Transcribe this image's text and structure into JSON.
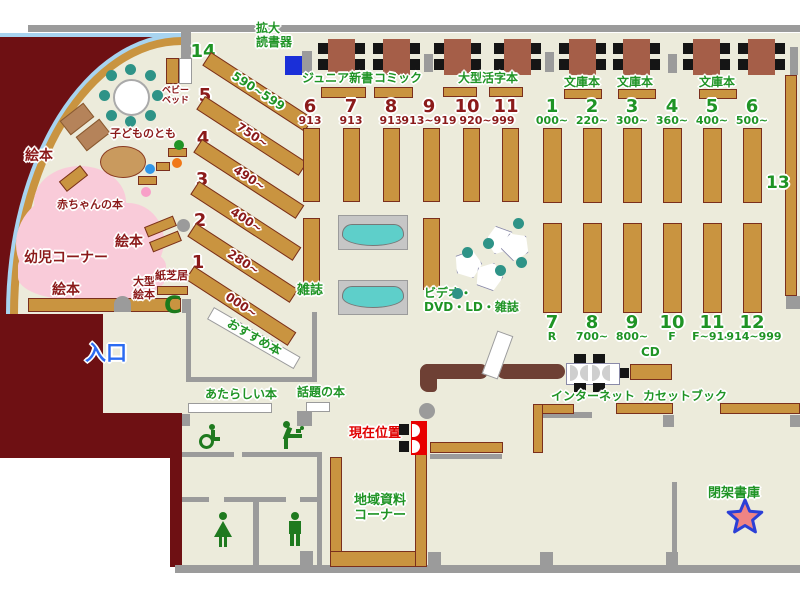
{
  "title": "library-floor-map",
  "colors": {
    "floor": "#ecebdb",
    "outside": "#6e1013",
    "wall": "#9b9b9b",
    "shelf_tan": "#c99440",
    "shelf_border": "#7a2f1d",
    "counter": "#6e4034",
    "table_brown": "#a55e48",
    "chair_black": "#151515",
    "teal_seat": "#2e9387",
    "magazine_rack_teal": "#5ecfca",
    "kids_pink": "#f9cbd9",
    "window_blue": "#a8d4f0",
    "label_green": "#1f9425",
    "label_dark_red": "#8b1a1a",
    "current_red": "#e00000",
    "entrance_blue": "#2b6bf2",
    "reader_blue": "#1a2fd8",
    "star_fill": "#ef8484",
    "star_stroke": "#2b3fd6"
  },
  "labels": {
    "magnifier_line1": "拡大",
    "magnifier_line2": "読書器",
    "junior_shinsho": "ジュニア新書",
    "comic": "コミック",
    "large_print": "大型活字本",
    "bunko_1": "文庫本",
    "bunko_2": "文庫本",
    "bunko_3": "文庫本",
    "magazines": "雑誌",
    "video_line1": "ビデオ・",
    "video_line2": "DVD・LD・雑誌",
    "recommended": "おすすめ本",
    "new_books": "あたらしい本",
    "topic_books": "話題の本",
    "local_line1": "地域資料",
    "local_line2": "コーナー",
    "internet": "インターネット",
    "cd": "CD",
    "cassette": "カセットブック",
    "closed_stacks": "閉架書庫",
    "current_location": "現在位置",
    "entrance": "入口",
    "picture_books_1": "絵本",
    "picture_books_2": "絵本",
    "picture_books_3": "絵本",
    "baby_books": "赤ちゃんの本",
    "toddler_corner": "幼児コーナー",
    "kodomo_no_tomo": "子どものとも",
    "baby_bed_line1": "ベビー",
    "baby_bed_line2": "ベッド",
    "large_picture_line1": "大型",
    "large_picture_line2": "絵本",
    "kamishibai": "紙芝居"
  },
  "sections": {
    "left": [
      {
        "n": "14",
        "r": "590~599"
      },
      {
        "n": "5",
        "r": "750~"
      },
      {
        "n": "4",
        "r": "490~"
      },
      {
        "n": "3",
        "r": "400~"
      },
      {
        "n": "2",
        "r": "280~"
      },
      {
        "n": "1",
        "r": "000~"
      }
    ],
    "mid": [
      {
        "n": "6",
        "r": "913"
      },
      {
        "n": "7",
        "r": "913"
      },
      {
        "n": "8",
        "r": "913"
      },
      {
        "n": "9",
        "r": "913~919"
      },
      {
        "n": "10",
        "r": "920~999"
      },
      {
        "n": "11",
        "r": ""
      }
    ],
    "right_top": [
      {
        "n": "1",
        "r": "000~"
      },
      {
        "n": "2",
        "r": "220~"
      },
      {
        "n": "3",
        "r": "300~"
      },
      {
        "n": "4",
        "r": "360~"
      },
      {
        "n": "5",
        "r": "400~"
      },
      {
        "n": "6",
        "r": "500~"
      }
    ],
    "right_bottom": [
      {
        "n": "7",
        "r": "R"
      },
      {
        "n": "8",
        "r": "700~"
      },
      {
        "n": "9",
        "r": "800~"
      },
      {
        "n": "10",
        "r": "F"
      },
      {
        "n": "11",
        "r": "F~914"
      },
      {
        "n": "12",
        "r": "914~999"
      }
    ],
    "shelf13": "13"
  }
}
